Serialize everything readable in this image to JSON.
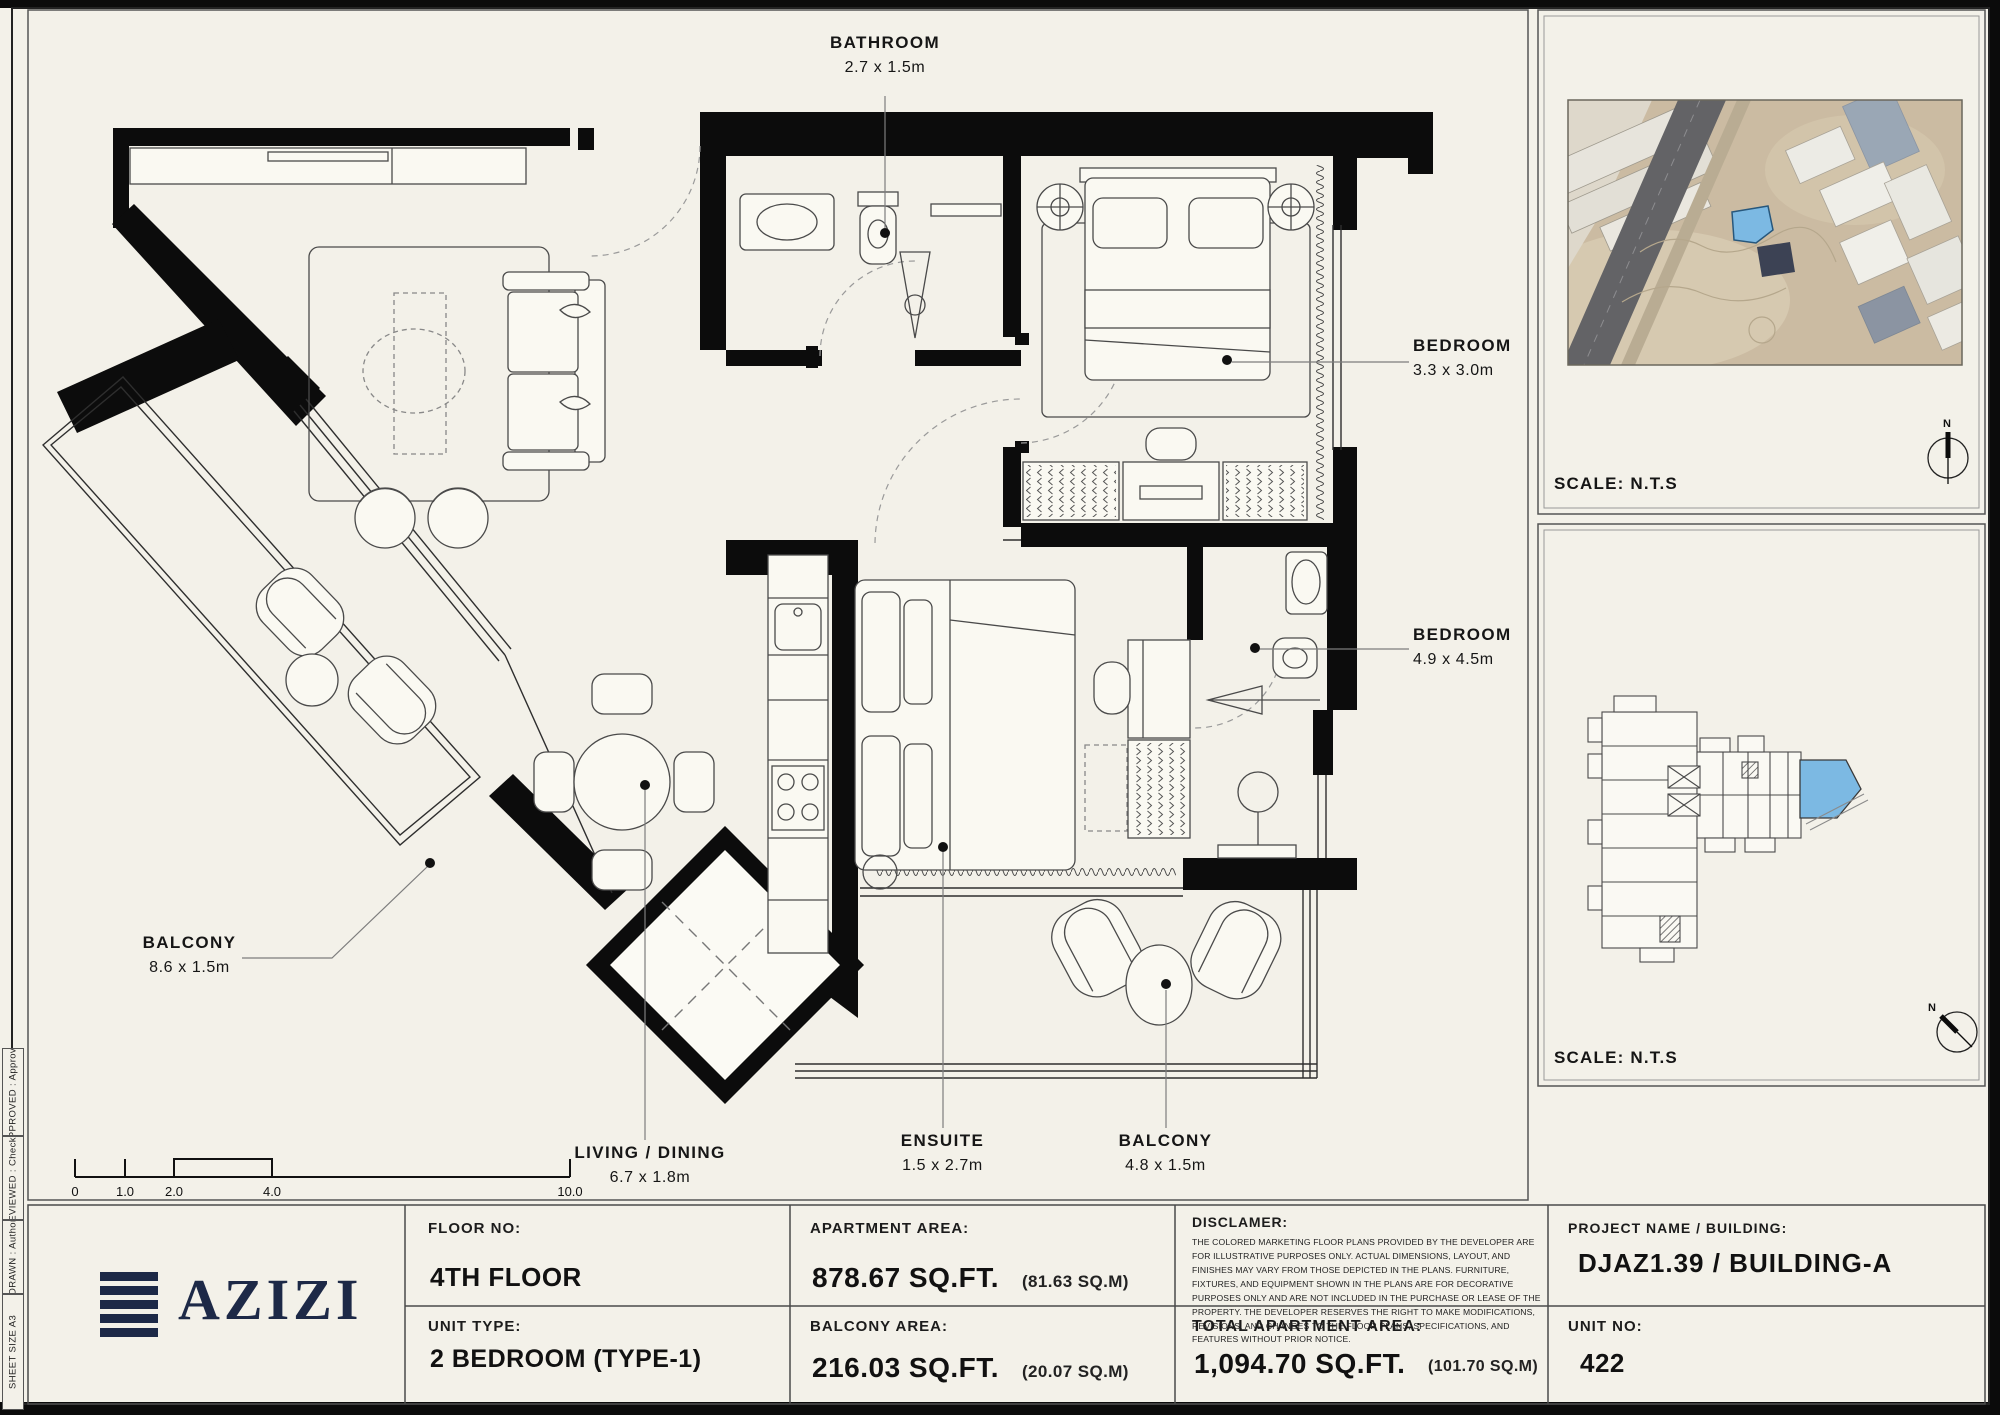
{
  "plan_labels": {
    "bathroom": {
      "name": "BATHROOM",
      "dims": "2.7 x 1.5m"
    },
    "bedroom_top": {
      "name": "BEDROOM",
      "dims": "3.3 x 3.0m"
    },
    "bedroom_main": {
      "name": "BEDROOM",
      "dims": "4.9 x 4.5m"
    },
    "balcony_left": {
      "name": "BALCONY",
      "dims": "8.6 x 1.5m"
    },
    "living": {
      "name": "LIVING / DINING",
      "dims": "6.7 x 1.8m"
    },
    "ensuite": {
      "name": "ENSUITE",
      "dims": "1.5 x 2.7m"
    },
    "balcony_bottom": {
      "name": "BALCONY",
      "dims": "4.8 x 1.5m"
    }
  },
  "scale_bar": {
    "ticks": [
      "0",
      "1.0",
      "2.0",
      "4.0",
      "10.0"
    ]
  },
  "map_panel": {
    "scale": "SCALE: N.T.S",
    "north": "N"
  },
  "key_panel": {
    "scale": "SCALE: N.T.S",
    "north": "N"
  },
  "title_block": {
    "logo": "AZIZI",
    "floor_label": "FLOOR NO:",
    "floor_value": "4TH FLOOR",
    "unit_type_label": "UNIT TYPE:",
    "unit_type_value": "2 BEDROOM (TYPE-1)",
    "apartment_area_label": "APARTMENT AREA:",
    "apartment_area_value": "878.67 SQ.FT.",
    "apartment_area_metric": "(81.63 SQ.M)",
    "balcony_area_label": "BALCONY AREA:",
    "balcony_area_value": "216.03 SQ.FT.",
    "balcony_area_metric": "(20.07 SQ.M)",
    "disclaimer_label": "DISCLAMER:",
    "disclaimer_text": "THE COLORED MARKETING FLOOR PLANS PROVIDED BY THE DEVELOPER ARE FOR ILLUSTRATIVE PURPOSES ONLY. ACTUAL DIMENSIONS, LAYOUT, AND FINISHES MAY VARY FROM THOSE DEPICTED IN THE PLANS. FURNITURE, FIXTURES, AND EQUIPMENT SHOWN IN THE PLANS ARE FOR DECORATIVE PURPOSES ONLY AND ARE NOT INCLUDED IN THE PURCHASE OR LEASE OF THE PROPERTY. THE DEVELOPER RESERVES THE RIGHT TO MAKE MODIFICATIONS, REVISIONS, AND CHANGES TO THE FLOOR PLANS, SPECIFICATIONS, AND FEATURES WITHOUT PRIOR NOTICE.",
    "total_area_label": "TOTAL APARTMENT AREA:",
    "total_area_value": "1,094.70 SQ.FT.",
    "total_area_metric": "(101.70 SQ.M)",
    "project_label": "PROJECT NAME / BUILDING:",
    "project_value": "DJAZ1.39 / BUILDING-A",
    "unit_no_label": "UNIT NO:",
    "unit_no_value": "422"
  },
  "edge_strip": {
    "items": [
      "SHEET SIZE A3",
      "DRAWN :  Author",
      "REVIEWED :  Checker",
      "APPROVED :  Approver"
    ]
  },
  "colors": {
    "accent_blue": "#7cb9e3",
    "logo_navy": "#1d2947",
    "sheet_bg": "#f3f1e9"
  }
}
